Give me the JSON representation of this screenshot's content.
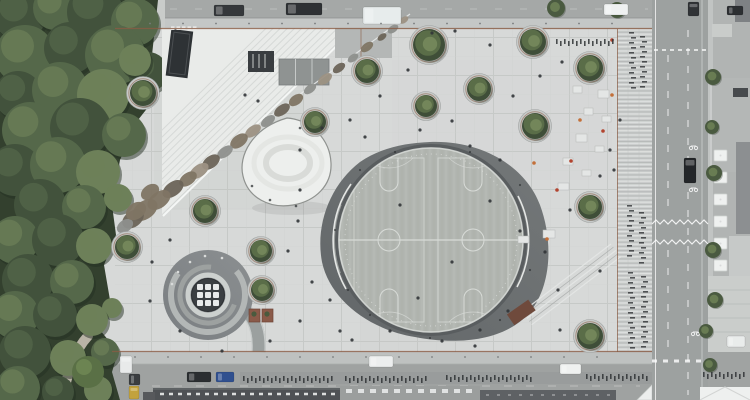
{
  "meta": {
    "width": 750,
    "height": 400,
    "scene": "aerial-top-down-plaza"
  },
  "palette": {
    "plaza": "#d7d9d8",
    "plaza_grid": "#c5c8c6",
    "asphalt": "#a0a3a2",
    "sidewalk": "#c4c7c6",
    "rust_border": "#8a5c44",
    "court_ring_a": "#747879",
    "court_ring_b": "#636769",
    "court_floor": "#b2b6b1",
    "court_line": "#dfe2df",
    "mound": "#edefed",
    "spiral_a": "#8b8f91",
    "spiral_b": "#7c8083",
    "spiral_center": "#3b3f42",
    "park_greens": [
      "#42523c",
      "#55684a",
      "#6d8059"
    ],
    "park_base": "#33402e",
    "tree_dark": "#3f4e38",
    "tree_mid": "#5a6d48",
    "tree_light": "#75885c",
    "creek_colors": [
      "#8d8f8c",
      "#9c9183",
      "#807564",
      "#6b6458"
    ],
    "bike": "#2f3235",
    "person": "#313437",
    "stall": "#e4e6e5",
    "roof_dark": "#4f5255",
    "tent": "#eceeed"
  },
  "park": {
    "canopy": [
      [
        20,
        15,
        26,
        0
      ],
      [
        55,
        8,
        22,
        1
      ],
      [
        95,
        12,
        28,
        0
      ],
      [
        135,
        22,
        24,
        1
      ],
      [
        25,
        55,
        30,
        1
      ],
      [
        70,
        48,
        26,
        0
      ],
      [
        115,
        55,
        30,
        1
      ],
      [
        148,
        72,
        20,
        0
      ],
      [
        18,
        95,
        24,
        0
      ],
      [
        60,
        90,
        28,
        1
      ],
      [
        103,
        95,
        26,
        2
      ],
      [
        135,
        60,
        16,
        2
      ],
      [
        30,
        130,
        28,
        1
      ],
      [
        80,
        128,
        30,
        0
      ],
      [
        124,
        135,
        22,
        1
      ],
      [
        15,
        170,
        26,
        0
      ],
      [
        58,
        165,
        28,
        1
      ],
      [
        98,
        172,
        22,
        2
      ],
      [
        40,
        205,
        26,
        0
      ],
      [
        84,
        207,
        22,
        1
      ],
      [
        118,
        198,
        14,
        2
      ],
      [
        15,
        240,
        24,
        1
      ],
      [
        58,
        240,
        26,
        0
      ],
      [
        94,
        246,
        18,
        2
      ],
      [
        28,
        280,
        26,
        0
      ],
      [
        72,
        282,
        22,
        1
      ],
      [
        112,
        308,
        10,
        2
      ],
      [
        15,
        315,
        24,
        1
      ],
      [
        55,
        315,
        22,
        0
      ],
      [
        92,
        320,
        16,
        2
      ],
      [
        25,
        352,
        26,
        0
      ],
      [
        68,
        358,
        18,
        2
      ],
      [
        105,
        352,
        14,
        1
      ],
      [
        18,
        388,
        22,
        1
      ],
      [
        58,
        392,
        16,
        0
      ],
      [
        98,
        390,
        14,
        2
      ]
    ],
    "bush": [
      88,
      372,
      16
    ]
  },
  "plaza_trees": [
    [
      429,
      45,
      16
    ],
    [
      367,
      71,
      12
    ],
    [
      479,
      89,
      12
    ],
    [
      426,
      106,
      11
    ],
    [
      315,
      122,
      11
    ],
    [
      533,
      42,
      13
    ],
    [
      590,
      68,
      13
    ],
    [
      535,
      126,
      13
    ],
    [
      143,
      93,
      13
    ],
    [
      205,
      211,
      12
    ],
    [
      127,
      247,
      12
    ],
    [
      261,
      251,
      11
    ],
    [
      262,
      290,
      11
    ],
    [
      590,
      207,
      12
    ],
    [
      590,
      336,
      13
    ]
  ],
  "street_trees": [
    [
      556,
      8,
      9
    ],
    [
      617,
      10,
      8
    ]
  ],
  "right_trees": [
    [
      713,
      77,
      8
    ],
    [
      712,
      127,
      7
    ],
    [
      714,
      173,
      8
    ],
    [
      713,
      250,
      8
    ],
    [
      715,
      300,
      8
    ],
    [
      706,
      331,
      7
    ],
    [
      710,
      365,
      7
    ]
  ],
  "creek_blobs": [
    [
      404,
      20,
      5,
      3,
      1
    ],
    [
      393,
      29,
      6,
      3.5,
      0
    ],
    [
      382,
      37,
      5,
      3,
      3
    ],
    [
      367,
      47,
      7,
      4,
      2
    ],
    [
      353,
      58,
      6,
      3.5,
      0
    ],
    [
      339,
      68,
      7,
      4,
      3
    ],
    [
      325,
      79,
      8,
      4.5,
      1
    ],
    [
      310,
      89,
      7,
      4,
      0
    ],
    [
      296,
      100,
      8,
      5,
      2
    ],
    [
      282,
      110,
      9,
      5,
      3
    ],
    [
      268,
      121,
      8,
      4.5,
      0
    ],
    [
      253,
      131,
      9,
      5,
      1
    ],
    [
      239,
      141,
      10,
      6,
      2
    ],
    [
      225,
      152,
      9,
      5,
      0
    ],
    [
      211,
      162,
      10,
      6,
      3
    ],
    [
      199,
      171,
      11,
      6,
      1
    ],
    [
      188,
      179,
      10,
      6,
      2
    ],
    [
      173,
      189,
      12,
      7,
      3
    ],
    [
      159,
      200,
      13,
      8,
      2
    ],
    [
      145,
      210,
      14,
      9,
      2
    ],
    [
      133,
      219,
      12,
      8,
      3
    ],
    [
      125,
      226,
      9,
      6,
      0
    ],
    [
      150,
      192,
      10,
      7,
      2
    ],
    [
      136,
      211,
      11,
      8,
      2
    ]
  ],
  "ramp": {
    "x1": 352,
    "y1": 28,
    "x2": 162,
    "y2": 214,
    "count": 12,
    "gap": 5
  },
  "cars": [
    [
      214,
      5,
      30,
      11,
      "#35383b"
    ],
    [
      286,
      3,
      36,
      12,
      "#2e3134"
    ],
    [
      363,
      7,
      38,
      17,
      "#e7ecec"
    ],
    [
      604,
      4,
      24,
      11,
      "#eff1f1"
    ],
    [
      688,
      2,
      11,
      14,
      "#303336"
    ],
    [
      727,
      6,
      16,
      9,
      "#2c2f32"
    ],
    [
      684,
      158,
      12,
      25,
      "#232629"
    ],
    [
      727,
      336,
      18,
      11,
      "#e9eceb"
    ],
    [
      369,
      356,
      24,
      11,
      "#eceeee"
    ],
    [
      560,
      364,
      21,
      10,
      "#eff1f0"
    ],
    [
      120,
      356,
      12,
      17,
      "#e8eaea"
    ],
    [
      129,
      374,
      11,
      11,
      "#3a3d40"
    ],
    [
      129,
      386,
      10,
      13,
      "#c2a23d"
    ],
    [
      187,
      372,
      24,
      10,
      "#2b2e31"
    ],
    [
      216,
      372,
      18,
      10,
      "#30508f"
    ]
  ],
  "bike_rows_h": [
    [
      243,
      332,
      377
    ],
    [
      345,
      428,
      377
    ],
    [
      446,
      532,
      376
    ],
    [
      586,
      648,
      375
    ],
    [
      703,
      746,
      373
    ],
    [
      556,
      614,
      40
    ]
  ],
  "bike_rows_v": [
    [
      32,
      88,
      630
    ],
    [
      36,
      86,
      641
    ],
    [
      205,
      258,
      628
    ],
    [
      212,
      262,
      640
    ],
    [
      272,
      348,
      629
    ],
    [
      276,
      350,
      642
    ]
  ],
  "people": [
    [
      245,
      95
    ],
    [
      258,
      101
    ],
    [
      300,
      150
    ],
    [
      322,
      128
    ],
    [
      350,
      120
    ],
    [
      365,
      137
    ],
    [
      420,
      130
    ],
    [
      452,
      121
    ],
    [
      470,
      146
    ],
    [
      500,
      160
    ],
    [
      513,
      96
    ],
    [
      540,
      76
    ],
    [
      562,
      62
    ],
    [
      610,
      150
    ],
    [
      600,
      176
    ],
    [
      570,
      210
    ],
    [
      545,
      252
    ],
    [
      520,
      231
    ],
    [
      558,
      290
    ],
    [
      600,
      271
    ],
    [
      480,
      330
    ],
    [
      442,
      341
    ],
    [
      390,
      331
    ],
    [
      340,
      331
    ],
    [
      300,
      321
    ],
    [
      270,
      341
    ],
    [
      222,
      351
    ],
    [
      180,
      331
    ],
    [
      150,
      301
    ],
    [
      490,
      201
    ],
    [
      508,
      311
    ],
    [
      475,
      346
    ],
    [
      408,
      70
    ],
    [
      380,
      96
    ],
    [
      298,
      221
    ],
    [
      288,
      251
    ],
    [
      312,
      282
    ],
    [
      330,
      300
    ],
    [
      352,
      340
    ],
    [
      560,
      330
    ],
    [
      620,
      120
    ],
    [
      614,
      170
    ],
    [
      455,
      31
    ],
    [
      432,
      33
    ],
    [
      490,
      45
    ],
    [
      170,
      240
    ],
    [
      152,
      262
    ],
    [
      300,
      190
    ],
    [
      400,
      205
    ],
    [
      452,
      262
    ],
    [
      418,
      298
    ]
  ],
  "ring_specks": [
    [
      360,
      170
    ],
    [
      395,
      152
    ],
    [
      470,
      152
    ],
    [
      520,
      185
    ],
    [
      530,
      270
    ],
    [
      500,
      320
    ],
    [
      430,
      338
    ],
    [
      370,
      315
    ],
    [
      335,
      230
    ],
    [
      348,
      290
    ]
  ],
  "mound_dots": [
    [
      270,
      200
    ],
    [
      296,
      206
    ],
    [
      252,
      186
    ],
    [
      300,
      128
    ]
  ],
  "market": {
    "stalls": [
      [
        573,
        86,
        9,
        7
      ],
      [
        598,
        90,
        11,
        8
      ],
      [
        584,
        108,
        9,
        7
      ],
      [
        602,
        116,
        9,
        6
      ],
      [
        576,
        134,
        11,
        8
      ],
      [
        595,
        146,
        9,
        6
      ],
      [
        563,
        158,
        10,
        7
      ],
      [
        582,
        170,
        9,
        6
      ],
      [
        558,
        183,
        11,
        7
      ],
      [
        543,
        230,
        12,
        8
      ],
      [
        518,
        236,
        11,
        7
      ]
    ],
    "accents": [
      [
        571,
        161,
        "#b2442f"
      ],
      [
        534,
        163,
        "#c3703a"
      ],
      [
        603,
        131,
        "#b2442f"
      ],
      [
        612,
        95,
        "#c3703a"
      ],
      [
        557,
        190,
        "#b2442f"
      ],
      [
        547,
        239,
        "#c3703a"
      ],
      [
        612,
        40,
        "#b2442f"
      ],
      [
        580,
        120,
        "#c3703a"
      ]
    ]
  },
  "umbrellas": {
    "x": 714,
    "w": 13,
    "h": 11,
    "ys": [
      150,
      172,
      194,
      216,
      238,
      260
    ]
  },
  "spiral_dots": [
    [
      190,
      262
    ],
    [
      205,
      256
    ],
    [
      178,
      272
    ],
    [
      172,
      284
    ],
    [
      222,
      258
    ]
  ],
  "bollards": {
    "top_y": 23.5,
    "bottom_y": 357,
    "x1": 150,
    "x2": 640,
    "step": 33
  }
}
